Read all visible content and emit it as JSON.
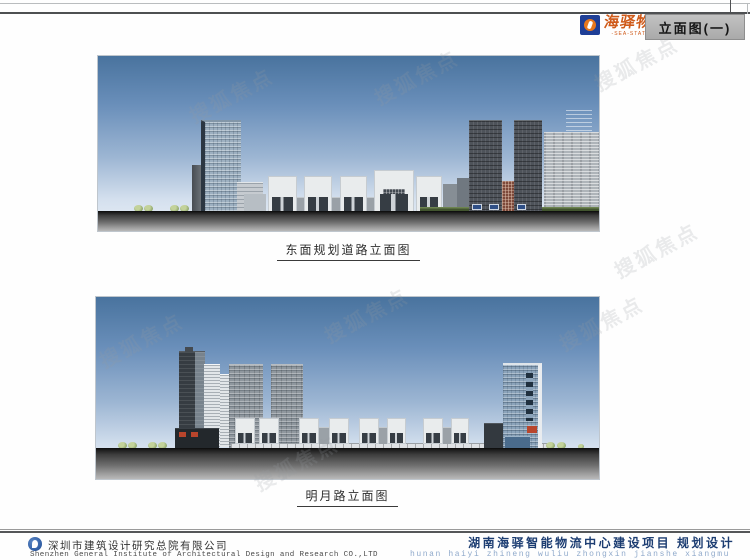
{
  "header": {
    "brand": {
      "name": "海驿物流",
      "subtitle": "-SEA-STATION-"
    },
    "sheet_title": "立面图(一)"
  },
  "figures": [
    {
      "label": "东面规划道路立面图"
    },
    {
      "label": "明月路立面图"
    }
  ],
  "footer": {
    "company_cn": "深圳市建筑设计研究总院有限公司",
    "company_en": "Shenzhen General Institute of Architectural Design and Research CO.,LTD",
    "project_cn": "湖南海驿智能物流中心建设项目  规划设计",
    "project_pinyin": "hunan haiyi zhineng wuliu zhongxin jianshe xiangmu"
  },
  "watermark": {
    "text": "搜狐焦点"
  },
  "colors": {
    "accent_orange": "#cf5a1a",
    "logo_blue": "#1e3e96",
    "title_box_bg": "#b5b5b5",
    "project_text_blue": "#1c3d72",
    "pinyin_blue": "#8fa9cb",
    "sky_top": "#49739e",
    "sky_bottom": "#e9eff6",
    "ground_dark": "#161616",
    "ground_light": "#b8b8b8"
  }
}
